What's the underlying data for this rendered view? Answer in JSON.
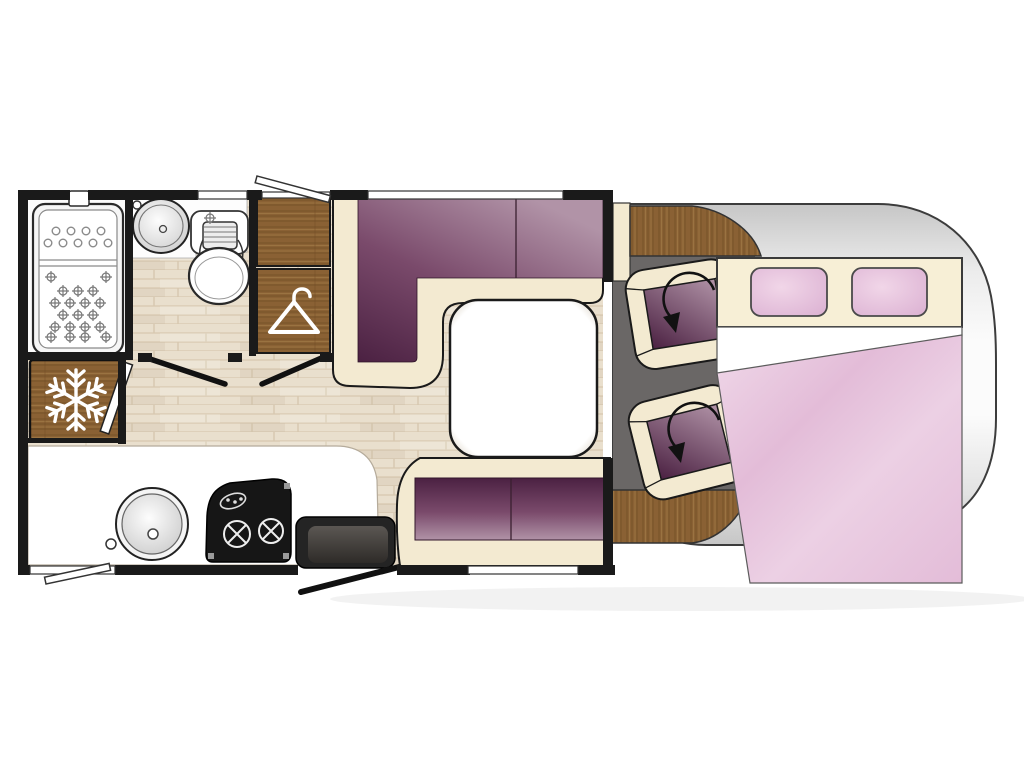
{
  "app": {
    "title": "Motorhome Floor Plan",
    "description": "Top-view interior layout drawing of a coachbuilt motorhome"
  },
  "canvas": {
    "width": 1024,
    "height": 768,
    "background": "#ffffff"
  },
  "colors": {
    "wall": "#1a1a1a",
    "outline": "#111111",
    "white": "#ffffff",
    "floor_base": "#e9dfcd",
    "floor_streak": "#d7c8af",
    "wood_base": "#8a6134",
    "wood_dark": "#6f4c25",
    "wood_light": "#a57e49",
    "cream": "#f3ead1",
    "headboard": "#f7efd6",
    "plum_dark": "#4b2142",
    "plum_mid": "#7a4a6b",
    "plum_light": "#b193a7",
    "cab_floor": "#6a6766",
    "body_gray": "#c6c6c6",
    "body_light": "#fbfbfb",
    "duvet_a": "#e3bcd8",
    "duvet_b": "#f0d9e9",
    "pillow_a": "#f1d6e8",
    "pillow_b": "#dcb2d3",
    "step_a": "#5b5753",
    "step_b": "#2e2b28",
    "table_edge": "#a99d8e"
  },
  "areas": {
    "bathroom": {
      "label": "Washroom with shower tray, washbasin and toilet"
    },
    "wardrobe": {
      "label": "Wardrobe with hanging rail"
    },
    "refrigerator": {
      "label": "Refrigerator / freezer"
    },
    "kitchen": {
      "label": "Kitchen with round sink and hob"
    },
    "lounge": {
      "label": "Lounge dinette with L-shaped sofa, table and bench seat"
    },
    "cab": {
      "label": "Driver cab with two swivel seats"
    },
    "bed": {
      "label": "Drop-down double bed with pillows and duvet"
    },
    "entry": {
      "label": "Entrance door with step"
    }
  },
  "icons": {
    "snowflake": "freezer compartment",
    "hanger": "wardrobe",
    "swivel_arrow": "seat rotates",
    "window_flap": "opening window"
  }
}
